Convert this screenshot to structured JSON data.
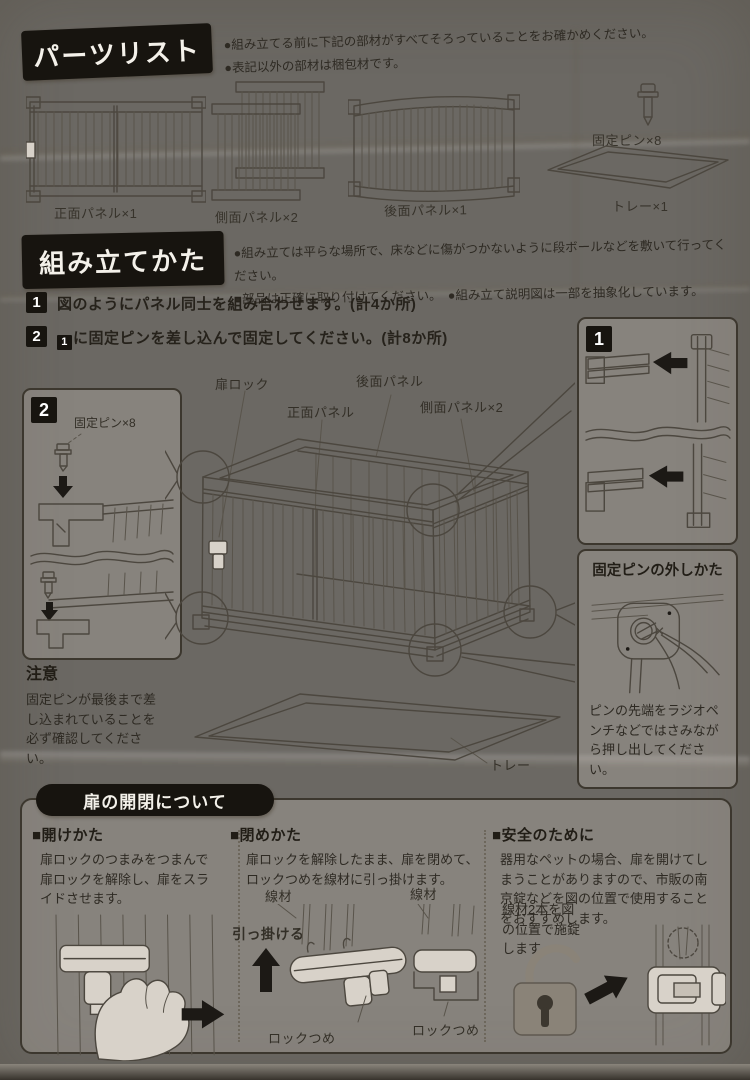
{
  "parts_list": {
    "title": "パーツリスト",
    "notes": [
      "●組み立てる前に下記の部材がすべてそろっていることをお確かめください。",
      "●表記以外の部材は梱包材です。"
    ],
    "parts": [
      {
        "label": "正面パネル×1"
      },
      {
        "label": "側面パネル×2"
      },
      {
        "label": "後面パネル×1"
      },
      {
        "label": "固定ピン×8"
      },
      {
        "label": "トレー×1"
      }
    ]
  },
  "assembly": {
    "title": "組み立てかた",
    "notes": [
      "●組み立ては平らな場所で、床などに傷がつかないように段ボールなどを敷いて行ってください。",
      "●部品は正確に取り付けてください。　●組み立て説明図は一部を抽象化しています。"
    ],
    "steps": [
      {
        "num": "1",
        "text": "図のようにパネル同士を組み合わせます。(計4か所)"
      },
      {
        "num": "2",
        "ref": "1",
        "text": "に固定ピンを差し込んで固定してください。(計8か所)"
      }
    ],
    "step1_box": {
      "badge": "1"
    },
    "step2_box": {
      "badge": "2",
      "pin_label": "固定ピン×8"
    },
    "diagram_labels": {
      "door_lock": "扉ロック",
      "front_panel": "正面パネル",
      "back_panel": "後面パネル",
      "side_panel": "側面パネル×2",
      "tray": "トレー"
    },
    "caution": {
      "title": "注意",
      "text": "固定ピンが最後まで差し込まれていることを必ず確認してください。"
    },
    "pin_removal": {
      "title": "固定ピンの外しかた",
      "text": "ピンの先端をラジオペンチなどではさみながら押し出してください。"
    }
  },
  "door_section": {
    "title": "扉の開閉について",
    "open": {
      "heading": "■開けかた",
      "text": "扉ロックのつまみをつまんで扉ロックを解除し、扉をスライドさせます。"
    },
    "close": {
      "heading": "■閉めかた",
      "text": "扉ロックを解除したまま、扉を閉めて、ロックつめを線材に引っ掛けます。",
      "wire_label_1": "線材",
      "wire_label_2": "線材",
      "hook_label": "引っ掛ける",
      "claw_label_1": "ロックつめ",
      "claw_label_2": "ロックつめ"
    },
    "safety": {
      "heading": "■安全のために",
      "text": "器用なペットの場合、扉を開けてしまうことがありますので、市販の南京錠などを図の位置で使用することをおすすめします。",
      "note": "線材2本を図の位置で施錠します。"
    }
  }
}
